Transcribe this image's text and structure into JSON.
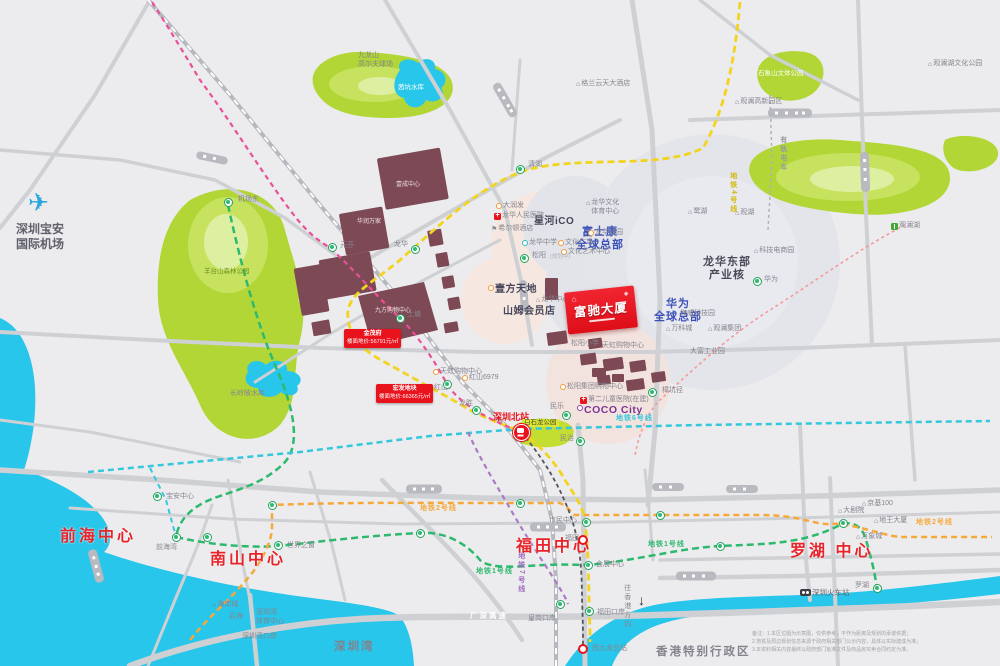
{
  "map": {
    "project": {
      "name": "富驰大厦"
    },
    "region_titles": [
      {
        "t": "前海中心",
        "x": 60,
        "y": 527
      },
      {
        "t": "南山中心",
        "x": 210,
        "y": 550
      },
      {
        "t": "福田中心",
        "x": 516,
        "y": 537
      },
      {
        "t": "罗湖  中心",
        "x": 790,
        "y": 542
      }
    ],
    "labels": [
      {
        "t": "富士康\n全球总部",
        "x": 600,
        "y": 226,
        "cls": "hq",
        "c": "#3d52b8",
        "ctr": 1
      },
      {
        "t": "华为\n全球总部",
        "x": 678,
        "y": 298,
        "cls": "hq",
        "c": "#3d52b8",
        "ctr": 1
      },
      {
        "t": "龙华东部\n产业核",
        "x": 727,
        "y": 256,
        "cls": "hq",
        "c": "#4a4a58",
        "ctr": 1
      },
      {
        "t": "星河iCO",
        "x": 534,
        "y": 216,
        "cls": "bd"
      },
      {
        "t": "壹方天地",
        "x": 488,
        "y": 284,
        "cls": "bd",
        "ic": "mall"
      },
      {
        "t": "山姆会员店",
        "x": 503,
        "y": 306,
        "cls": "bd"
      },
      {
        "t": "COCO City",
        "x": 577,
        "y": 404,
        "cls": "coco",
        "ic": "mallp"
      },
      {
        "t": "深圳宝安\n国际机场",
        "x": 16,
        "y": 222,
        "cls": "city"
      },
      {
        "t": "✈",
        "x": 28,
        "y": 188,
        "cls": "plane"
      },
      {
        "t": "深圳湾",
        "x": 334,
        "y": 640,
        "cls": "city2"
      },
      {
        "t": "香港特别行政区",
        "x": 656,
        "y": 645,
        "cls": "city2"
      },
      {
        "t": "深圳火车站",
        "x": 800,
        "y": 588,
        "cls": "s2",
        "ic": "train"
      },
      {
        "t": "深圳北站",
        "x": 493,
        "y": 412,
        "cls": "redlab"
      },
      {
        "t": "九龙山\n高尔夫球场",
        "x": 358,
        "y": 52,
        "cls": "s"
      },
      {
        "t": "茜坑水库",
        "x": 398,
        "y": 84,
        "cls": "wt"
      },
      {
        "t": "羊台山森林公园",
        "x": 204,
        "y": 268,
        "cls": "pk"
      },
      {
        "t": "长岭陂水库",
        "x": 230,
        "y": 390,
        "cls": "s"
      },
      {
        "t": "石象山文体公园",
        "x": 758,
        "y": 70,
        "cls": "pkw"
      },
      {
        "t": "观澜湖文化公园",
        "x": 928,
        "y": 60,
        "cls": "s",
        "ic": "home"
      },
      {
        "t": "观澜高新园区",
        "x": 735,
        "y": 98,
        "cls": "s",
        "ic": "home"
      },
      {
        "t": "鹭湖",
        "x": 688,
        "y": 208,
        "cls": "s",
        "ic": "home"
      },
      {
        "t": "观湖",
        "x": 735,
        "y": 209,
        "cls": "s",
        "ic": "home"
      },
      {
        "t": "科技电商园",
        "x": 754,
        "y": 247,
        "cls": "s",
        "ic": "home"
      },
      {
        "t": "海威科技园",
        "x": 680,
        "y": 310,
        "cls": "s"
      },
      {
        "t": "万科城",
        "x": 666,
        "y": 325,
        "cls": "s",
        "ic": "home"
      },
      {
        "t": "观澜集团",
        "x": 708,
        "y": 325,
        "cls": "s",
        "ic": "home"
      },
      {
        "t": "大富工业园",
        "x": 690,
        "y": 348,
        "cls": "s"
      },
      {
        "t": "观澜湖",
        "x": 891,
        "y": 222,
        "cls": "s",
        "ic": "tree"
      },
      {
        "t": "大润发",
        "x": 496,
        "y": 202,
        "cls": "s",
        "ic": "mall"
      },
      {
        "t": "龙华人民医院",
        "x": 494,
        "y": 212,
        "cls": "s",
        "ic": "hosp"
      },
      {
        "t": "希尔顿酒店",
        "x": 491,
        "y": 225,
        "cls": "s",
        "ic": "flag"
      },
      {
        "t": "格兰云天大酒店",
        "x": 576,
        "y": 80,
        "cls": "s",
        "ic": "home"
      },
      {
        "t": "龙华文化\n体育中心",
        "x": 586,
        "y": 199,
        "cls": "s",
        "ic": "home"
      },
      {
        "t": "龙华公园",
        "x": 588,
        "y": 229,
        "cls": "s",
        "ic": "mall"
      },
      {
        "t": "文化广场",
        "x": 558,
        "y": 239,
        "cls": "s",
        "ic": "mall"
      },
      {
        "t": "文化艺术中心",
        "x": 561,
        "y": 248,
        "cls": "s",
        "ic": "mall"
      },
      {
        "t": "龙华中学",
        "x": 522,
        "y": 239,
        "cls": "s",
        "ic": "school"
      },
      {
        "t": "龙华中心",
        "x": 536,
        "y": 296,
        "cls": "s",
        "ic": "home"
      },
      {
        "t": "松阳小学",
        "x": 571,
        "y": 340,
        "cls": "s"
      },
      {
        "t": "天虹购物中心",
        "x": 602,
        "y": 342,
        "cls": "s"
      },
      {
        "t": "天虹购物中心",
        "x": 433,
        "y": 368,
        "cls": "s",
        "ic": "mall"
      },
      {
        "t": "红山6979",
        "x": 462,
        "y": 374,
        "cls": "s",
        "ic": "mall"
      },
      {
        "t": "松阳集团购物中心",
        "x": 560,
        "y": 383,
        "cls": "s",
        "ic": "mall"
      },
      {
        "t": "第二儿童医院(在建)",
        "x": 580,
        "y": 396,
        "cls": "s",
        "ic": "hosp"
      },
      {
        "t": "白石龙公园",
        "x": 522,
        "y": 419,
        "cls": "hl"
      },
      {
        "t": "广深高速",
        "x": 470,
        "y": 611,
        "cls": "road"
      },
      {
        "t": "往香港方向",
        "x": 622,
        "y": 584,
        "cls": "s",
        "v": 1
      },
      {
        "t": "↓",
        "x": 638,
        "y": 592,
        "cls": "arrow"
      },
      {
        "t": "壹成中心",
        "x": 408,
        "y": 182,
        "cls": "w",
        "ctr": 1
      },
      {
        "t": "华润万家",
        "x": 369,
        "y": 219,
        "cls": "w",
        "ctr": 1
      },
      {
        "t": "九方购物中心",
        "x": 393,
        "y": 308,
        "cls": "w",
        "ctr": 1
      },
      {
        "t": "宝安中心",
        "x": 166,
        "y": 493,
        "cls": "s"
      },
      {
        "t": "前海湾",
        "x": 156,
        "y": 544,
        "cls": "s"
      },
      {
        "t": "世界之窗",
        "x": 287,
        "y": 542,
        "cls": "s"
      },
      {
        "t": "海岸城",
        "x": 212,
        "y": 601,
        "cls": "s",
        "ic": "home"
      },
      {
        "t": "后海",
        "x": 229,
        "y": 613,
        "cls": "s"
      },
      {
        "t": "深圳湾\n体育中心",
        "x": 256,
        "y": 609,
        "cls": "s"
      },
      {
        "t": "深圳湾口岸",
        "x": 242,
        "y": 633,
        "cls": "s"
      },
      {
        "t": "市民中心",
        "x": 549,
        "y": 517,
        "cls": "s"
      },
      {
        "t": "福田",
        "x": 565,
        "y": 535,
        "cls": "s"
      },
      {
        "t": "会展中心",
        "x": 596,
        "y": 561,
        "cls": "s"
      },
      {
        "t": "福田口岸",
        "x": 597,
        "y": 609,
        "cls": "s"
      },
      {
        "t": "皇岗口岸",
        "x": 528,
        "y": 615,
        "cls": "s"
      },
      {
        "t": "西九龙总站",
        "x": 592,
        "y": 645,
        "cls": "s"
      },
      {
        "t": "大剧院",
        "x": 838,
        "y": 507,
        "cls": "s",
        "ic": "home"
      },
      {
        "t": "京基100",
        "x": 862,
        "y": 500,
        "cls": "s",
        "ic": "home"
      },
      {
        "t": "地王大厦",
        "x": 874,
        "y": 517,
        "cls": "s",
        "ic": "home"
      },
      {
        "t": "万象城",
        "x": 856,
        "y": 533,
        "cls": "s",
        "ic": "home"
      },
      {
        "t": "罗湖",
        "x": 855,
        "y": 582,
        "cls": "s"
      },
      {
        "t": "机场东",
        "x": 238,
        "y": 196,
        "cls": "s"
      },
      {
        "t": "元芬",
        "x": 340,
        "y": 242,
        "cls": "s"
      },
      {
        "t": "清湖",
        "x": 528,
        "y": 161,
        "cls": "s"
      },
      {
        "t": "龙华",
        "x": 394,
        "y": 241,
        "cls": "s"
      },
      {
        "t": "上塘",
        "x": 407,
        "y": 311,
        "cls": "s"
      },
      {
        "t": "红山",
        "x": 434,
        "y": 384,
        "cls": "s"
      },
      {
        "t": "龙胜",
        "x": 459,
        "y": 400,
        "cls": "s"
      },
      {
        "t": "民治",
        "x": 560,
        "y": 435,
        "cls": "s"
      },
      {
        "t": "民乐",
        "x": 550,
        "y": 403,
        "cls": "s"
      },
      {
        "t": "松阳",
        "x": 532,
        "y": 252,
        "cls": "s"
      },
      {
        "t": "(规划中)",
        "x": 550,
        "y": 254,
        "cls": "xs"
      },
      {
        "t": "华为",
        "x": 764,
        "y": 276,
        "cls": "s"
      },
      {
        "t": "樟坑径",
        "x": 662,
        "y": 387,
        "cls": "s"
      }
    ],
    "metro_line_labels": [
      {
        "t": "地铁1号线",
        "x": 476,
        "y": 568,
        "c": "#2db96e"
      },
      {
        "t": "地铁1号线",
        "x": 648,
        "y": 541,
        "c": "#2db96e"
      },
      {
        "t": "地铁2号线",
        "x": 420,
        "y": 505,
        "c": "#f6a93b"
      },
      {
        "t": "地铁2号线",
        "x": 916,
        "y": 519,
        "c": "#f6a93b"
      },
      {
        "t": "地铁6号线",
        "x": 616,
        "y": 415,
        "c": "#35c8dc"
      },
      {
        "t": "地铁4号线",
        "x": 728,
        "y": 172,
        "c": "#d4b80a",
        "v": 1
      },
      {
        "t": "地铁7号线",
        "x": 516,
        "y": 552,
        "c": "#a06cc0",
        "v": 1
      },
      {
        "t": "有轨电车",
        "x": 778,
        "y": 136,
        "c": "#9a9aa2",
        "v": 1
      }
    ],
    "stations": [
      {
        "x": 228,
        "y": 202,
        "type": "g"
      },
      {
        "x": 332,
        "y": 247,
        "type": "g"
      },
      {
        "x": 520,
        "y": 169,
        "type": "g"
      },
      {
        "x": 415,
        "y": 249,
        "type": "g"
      },
      {
        "x": 524,
        "y": 258,
        "type": "g"
      },
      {
        "x": 400,
        "y": 318,
        "type": "g"
      },
      {
        "x": 447,
        "y": 384,
        "type": "g"
      },
      {
        "x": 476,
        "y": 410,
        "type": "g"
      },
      {
        "x": 757,
        "y": 281,
        "type": "g"
      },
      {
        "x": 652,
        "y": 392,
        "type": "g"
      },
      {
        "x": 566,
        "y": 415,
        "type": "g"
      },
      {
        "x": 580,
        "y": 441,
        "type": "g"
      },
      {
        "x": 157,
        "y": 496,
        "type": "g"
      },
      {
        "x": 176,
        "y": 537,
        "type": "g"
      },
      {
        "x": 278,
        "y": 545,
        "type": "g"
      },
      {
        "x": 207,
        "y": 537,
        "type": "g"
      },
      {
        "x": 586,
        "y": 522,
        "type": "g"
      },
      {
        "x": 588,
        "y": 565,
        "type": "g"
      },
      {
        "x": 589,
        "y": 611,
        "type": "g"
      },
      {
        "x": 560,
        "y": 604,
        "type": "g"
      },
      {
        "x": 843,
        "y": 523,
        "type": "g"
      },
      {
        "x": 877,
        "y": 588,
        "type": "g"
      },
      {
        "x": 520,
        "y": 503,
        "type": "g"
      },
      {
        "x": 272,
        "y": 505,
        "type": "g"
      },
      {
        "x": 660,
        "y": 515,
        "type": "g"
      },
      {
        "x": 420,
        "y": 533,
        "type": "g"
      },
      {
        "x": 720,
        "y": 546,
        "type": "g"
      },
      {
        "x": 583,
        "y": 540,
        "type": "r"
      },
      {
        "x": 583,
        "y": 649,
        "type": "r"
      },
      {
        "x": 521,
        "y": 432,
        "type": "hsr"
      }
    ],
    "price_tags": [
      {
        "l1": "金茂府",
        "l2": "楼面地价:56791元/㎡",
        "x": 344,
        "y": 329
      },
      {
        "l1": "宏发地块",
        "l2": "楼面地价:66365元/㎡",
        "x": 376,
        "y": 384
      }
    ],
    "notes": [
      "备注：1.本区位图为示意图，仅供参考，不作为距离及规划的承诺依据；",
      "2.地铁及周边规划信息来源于政府相关部门公示内容，具体以实际建成为准；",
      "3.本资料相关内容最终以政府部门批准文件及商品房买卖合同约定为准。"
    ],
    "colors": {
      "accent_red": "#e8131d",
      "hq_blue": "#3d52b8",
      "water": "#27c6ea",
      "park": "#b2d636",
      "line1_green": "#2db96e",
      "line2_orange": "#f6a93b",
      "line4_yellow": "#f2d41f",
      "line6_cyan": "#35c8dc",
      "magenta": "#ea4f98",
      "purple": "#ab7ac5",
      "building": "#7c4954"
    }
  }
}
